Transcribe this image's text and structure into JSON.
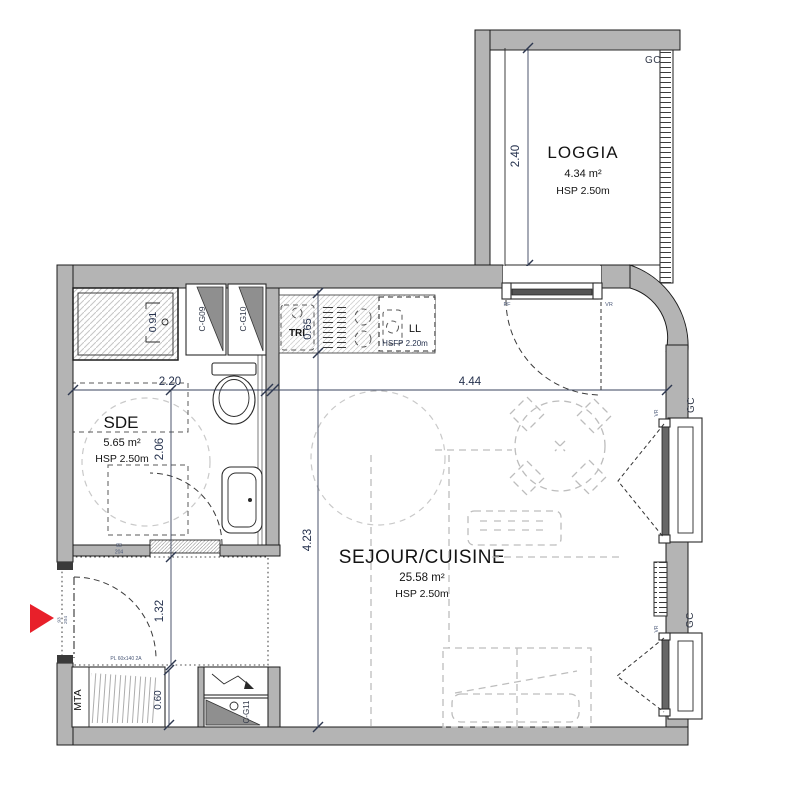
{
  "title": "Studio apartment floor plan",
  "rooms": {
    "loggia": {
      "name": "LOGGIA",
      "area": "4.34 m²",
      "height": "HSP 2.50m"
    },
    "sde": {
      "name": "SDE",
      "area": "5.65 m²",
      "height": "HSP 2.50m"
    },
    "sejour": {
      "name": "SEJOUR/CUISINE",
      "area": "25.58 m²",
      "height": "HSP 2.50m"
    }
  },
  "labels": {
    "gc_loggia": "GC",
    "gc_window_top": "GC",
    "gc_window_bottom": "GC",
    "pf": "PF",
    "vr_door": "VR",
    "vr_window_top": "VR",
    "vr_window_bottom": "VR",
    "tri": "TRI",
    "ll": "LL",
    "ll_height": "HSFP 2.20m",
    "mta": "MTA",
    "closet_note": "PL 60x140 2A"
  },
  "ducts": {
    "cg09": "C-G09",
    "cg10": "C-G10",
    "cg11": "C-G11"
  },
  "dimensions": {
    "loggia_depth": "2.40",
    "sde_width": "2.20",
    "sejour_width": "4.44",
    "kitchen_depth": "0.65",
    "sejour_depth": "4.23",
    "sde_inner_depth": "2.06",
    "entry_depth": "1.32",
    "shower_niche": "0.91",
    "closet_depth": "0.60"
  },
  "door_tags": {
    "entrance_width": "93",
    "entrance_height": "204",
    "sde_width": "83",
    "sde_height": "204"
  },
  "colors": {
    "wall": "#b4b4b4",
    "entrance_arrow": "#e8202a",
    "dimension_text": "#26324e"
  }
}
